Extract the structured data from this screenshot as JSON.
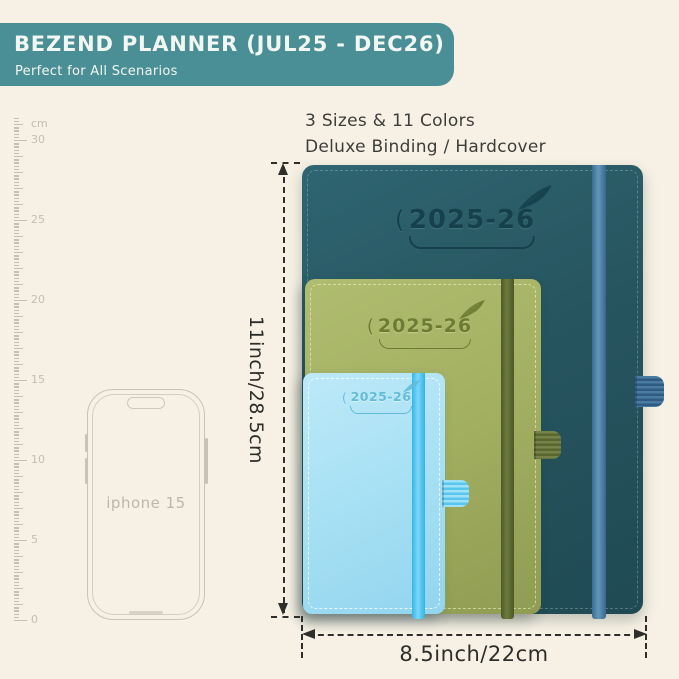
{
  "header": {
    "title": "BEZEND PLANNER (JUL25 - DEC26)",
    "subtitle": "Perfect for All Scenarios"
  },
  "info": {
    "line1": "3 Sizes & 11 Colors",
    "line2": "Deluxe Binding / Hardcover"
  },
  "ruler": {
    "unit": "cm",
    "tick_labels": [
      "30",
      "25",
      "20",
      "15",
      "10",
      "5",
      "0"
    ]
  },
  "phone": {
    "label": "iphone 15"
  },
  "planners": [
    {
      "name": "large",
      "year_label": "2025-26",
      "logo_mark": "("
    },
    {
      "name": "medium",
      "year_label": "2025-26",
      "logo_mark": "("
    },
    {
      "name": "small",
      "year_label": "2025-26",
      "logo_mark": "("
    }
  ],
  "dimensions": {
    "height_label": "11inch/28.5cm",
    "width_label": "8.5inch/22cm"
  },
  "colors": {
    "banner": "#4a8e96",
    "background": "#f6f1e4",
    "dim": "#2e2e2b",
    "large_body": "#27555f",
    "large_band": "#4a7da4",
    "medium_body": "#a2af61",
    "medium_band": "#5d6931",
    "small_body": "#a7e0f4",
    "small_band": "#49c2f0"
  }
}
